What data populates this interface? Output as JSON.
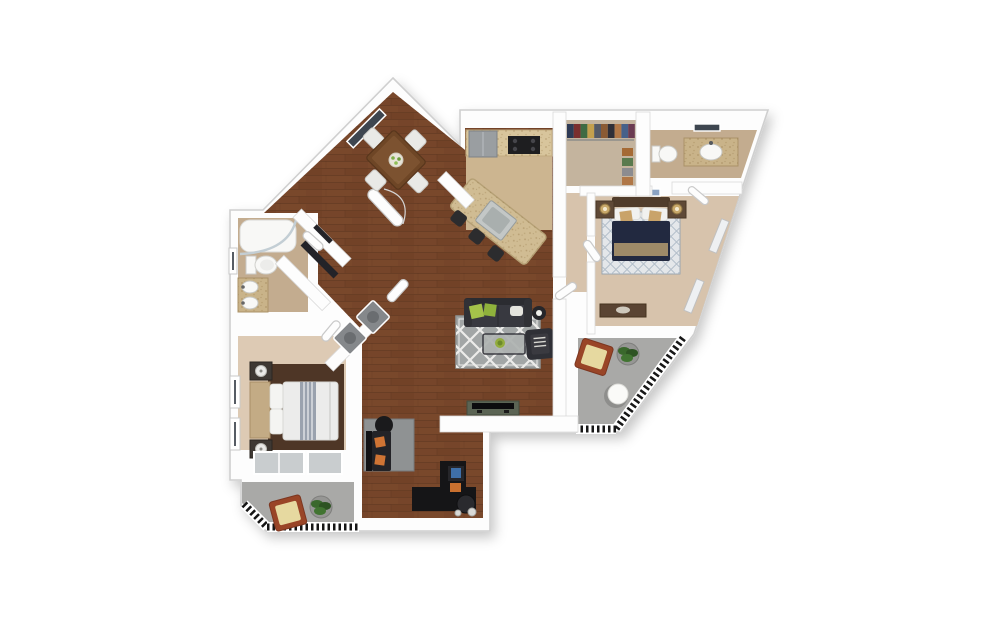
{
  "scene": {
    "kind": "3d-apartment-floor-plan-top-view",
    "canvas": {
      "width": 998,
      "height": 626,
      "background": "#ffffff"
    }
  },
  "colors": {
    "background": "#ffffff",
    "wall_fill": "#fdfdfd",
    "wall_stroke": "#cccccc",
    "wood": "#76452a",
    "tile_kitchen": "#ccb590",
    "counter": "#d8c59c",
    "granite": "#d0bc93",
    "fridge": "#9a9ea1",
    "stove": "#1e1e20",
    "sink_steel": "#c3c7c6",
    "stool": "#2c2c2e",
    "carpet_closet": "#c4b49e",
    "carpet_hall": "#d7c3ac",
    "carpet_bed2": "#d7c3ac",
    "carpet_master": "#ddcab4",
    "bath_floor": "#c3ac8f",
    "vanity": "#c9b389",
    "fixture_white": "#f8f8f6",
    "patio": "#a9a9a7",
    "railing": "#161616",
    "rug_living": "#a2a6a6",
    "rug_den": "#8f9293",
    "rug_bed2": "#e4e7ea",
    "rug_master": "#4e3626",
    "sofa_dark": "#383940",
    "sofa_back": "#2b2c31",
    "pillow_green": "#a4c24a",
    "pillow_white": "#e4e4de",
    "armchair": "#2f3036",
    "coffee_table": "#aeb3b1",
    "side_table": "#26262a",
    "tv_console": "#5b6454",
    "tv_black": "#0c0c0e",
    "dining_table": "#6e4626",
    "dining_chair": "#e9e9e6",
    "bed2_duvet": "#222940",
    "bed2_throw": "#9e8a68",
    "bed2_headboard": "#503c2b",
    "bed2_nightstand": "#5f4936",
    "lamp_gold": "#c9a96b",
    "dresser": "#5a4433",
    "master_duvet": "#ececeb",
    "master_stripe": "#9aa2ae",
    "master_headboard": "#c3ab85",
    "master_nightstand": "#3e3833",
    "lamp_white": "#e9e9e7",
    "den_sofa": "#232327",
    "pillow_orange": "#cf7434",
    "desk_black": "#151517",
    "monitor_screen": "#3f6fa8",
    "glass_door": "#c9cdcf",
    "window_dark": "#3e4650",
    "window_blue": "#8ba3c4",
    "patio_chair": "#994527",
    "patio_cushion": "#e6d9a0",
    "plant_green": "#3a682c",
    "plant_pot": "#969694",
    "washer": "#85888b",
    "accent_tan": "#c9a36a"
  },
  "closet": {
    "clothes_colors": [
      "#2e3a55",
      "#7a2e2e",
      "#3f6b43",
      "#c4a04e",
      "#555a66",
      "#8a5a33",
      "#2f2f38",
      "#b07747",
      "#46618a",
      "#6b3b52"
    ],
    "shoe_colors": [
      "#a56a35",
      "#5a7a4e",
      "#8c8c90",
      "#b07747"
    ]
  },
  "rooms": [
    {
      "id": "dining-area",
      "floor": "wood",
      "furniture": [
        "dining-table",
        "dining-chairs-x4",
        "centerpiece",
        "window"
      ]
    },
    {
      "id": "kitchen",
      "floor": "tile",
      "furniture": [
        "refrigerator",
        "range",
        "counter",
        "granite-island",
        "island-sink",
        "bar-stools-x3"
      ]
    },
    {
      "id": "walk-in-closet",
      "floor": "carpet",
      "furniture": [
        "hanging-clothes",
        "shoe-shelf"
      ]
    },
    {
      "id": "bathroom-2",
      "floor": "tile",
      "furniture": [
        "vanity-sink",
        "toilet",
        "window"
      ]
    },
    {
      "id": "bedroom-2",
      "floor": "carpet",
      "furniture": [
        "bed",
        "nightstands-x2",
        "lamps-x2",
        "area-rug",
        "dresser",
        "windows"
      ]
    },
    {
      "id": "patio-right",
      "floor": "concrete",
      "furniture": [
        "lounge-chair",
        "potted-plant",
        "round-table",
        "railing"
      ]
    },
    {
      "id": "hallway",
      "floor": "carpet",
      "furniture": []
    },
    {
      "id": "living-room",
      "floor": "wood",
      "furniture": [
        "sofa",
        "trellis-rug",
        "coffee-table",
        "armchair",
        "side-table",
        "tv-console",
        "television"
      ]
    },
    {
      "id": "bathroom-1",
      "floor": "tile",
      "furniture": [
        "curved-shower-tub",
        "toilet",
        "double-vanity"
      ]
    },
    {
      "id": "laundry-closet",
      "floor": "wood",
      "furniture": [
        "washer",
        "dryer"
      ]
    },
    {
      "id": "entry-foyer",
      "floor": "wood",
      "furniture": [
        "entry-door",
        "coat-closets"
      ]
    },
    {
      "id": "master-bedroom",
      "floor": "carpet",
      "furniture": [
        "bed",
        "headboard",
        "nightstands-x2",
        "lamps-x2",
        "area-rug",
        "sliding-glass-doors",
        "windows"
      ]
    },
    {
      "id": "patio-left",
      "floor": "concrete",
      "furniture": [
        "lounge-chair",
        "potted-plant",
        "railing"
      ]
    },
    {
      "id": "den-office",
      "floor": "wood",
      "furniture": [
        "sofa",
        "round-side-table",
        "area-rug",
        "l-shaped-desk",
        "computer-monitor",
        "office-chair"
      ]
    }
  ]
}
